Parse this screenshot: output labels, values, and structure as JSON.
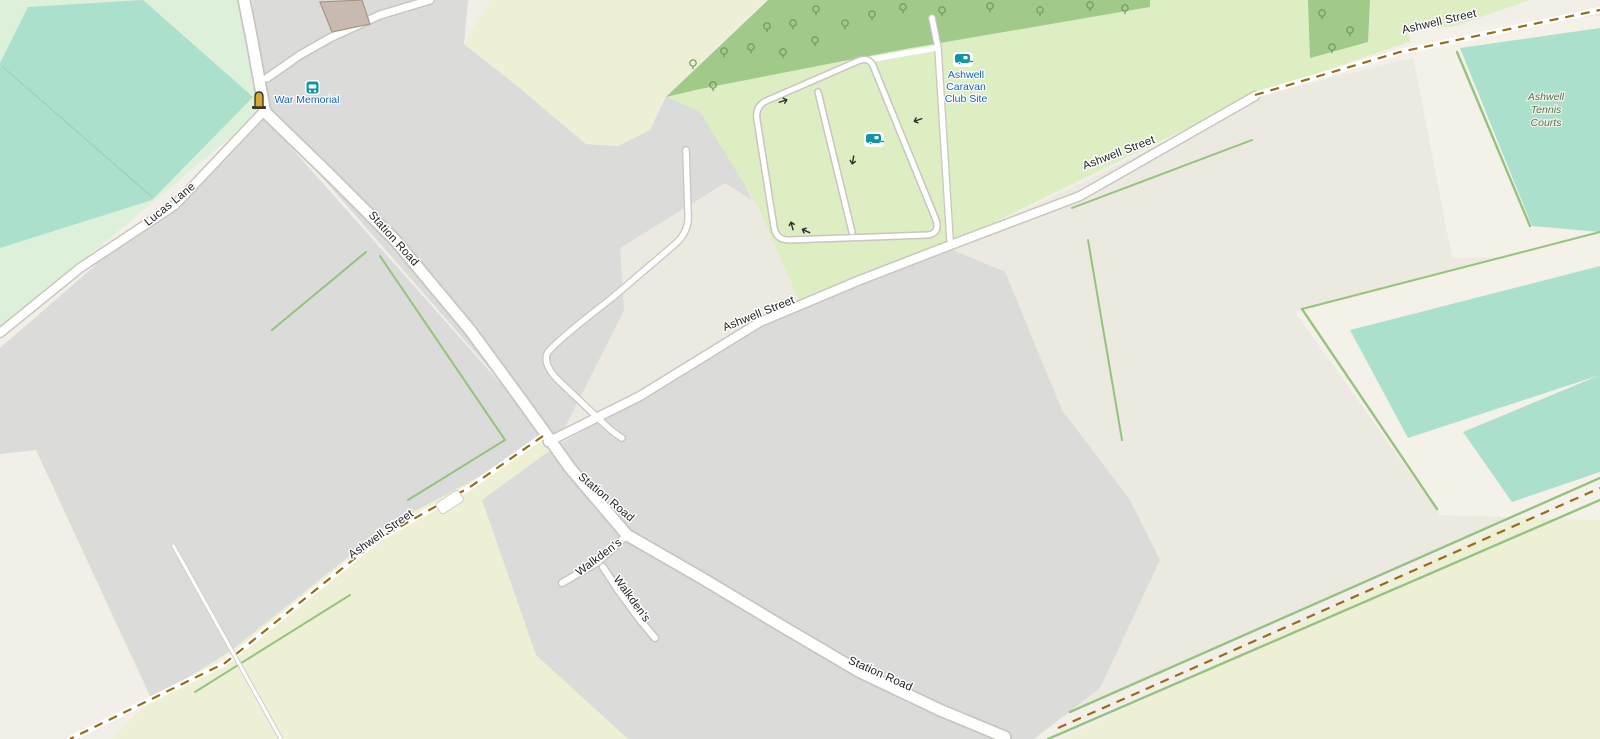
{
  "map": {
    "roads": {
      "station_road": "Station Road",
      "ashwell_street": "Ashwell Street",
      "lucas_lane": "Lucas Lane",
      "walkdens": "Walkden's"
    },
    "pois": {
      "war_memorial": "War Memorial",
      "caravan_lines": [
        "Ashwell",
        "Caravan",
        "Club Site"
      ],
      "tennis_lines": [
        "Ashwell",
        "Tennis",
        "Courts"
      ]
    },
    "colors": {
      "cream": "#f2efe9",
      "gray": "#dbdbd9",
      "beige": "#ece9e1",
      "farmland": "#eef0d5",
      "caravan_green": "#ddeec3",
      "park_green": "#dcf0da",
      "pitch_teal": "#abe0cc",
      "forest": "#a0c98a",
      "tree": "#6d9b53",
      "hedge": "#95c27f",
      "road_white": "#ffffff",
      "casing": "#c9c5bf",
      "byway_brown": "#9a6a18",
      "poi_blue": "#0d64c8",
      "tennis_green": "#4d7a52",
      "icon_teal": "#0e95a8",
      "building_fill": "#c9bab1",
      "building_stroke": "#a8968a"
    }
  }
}
